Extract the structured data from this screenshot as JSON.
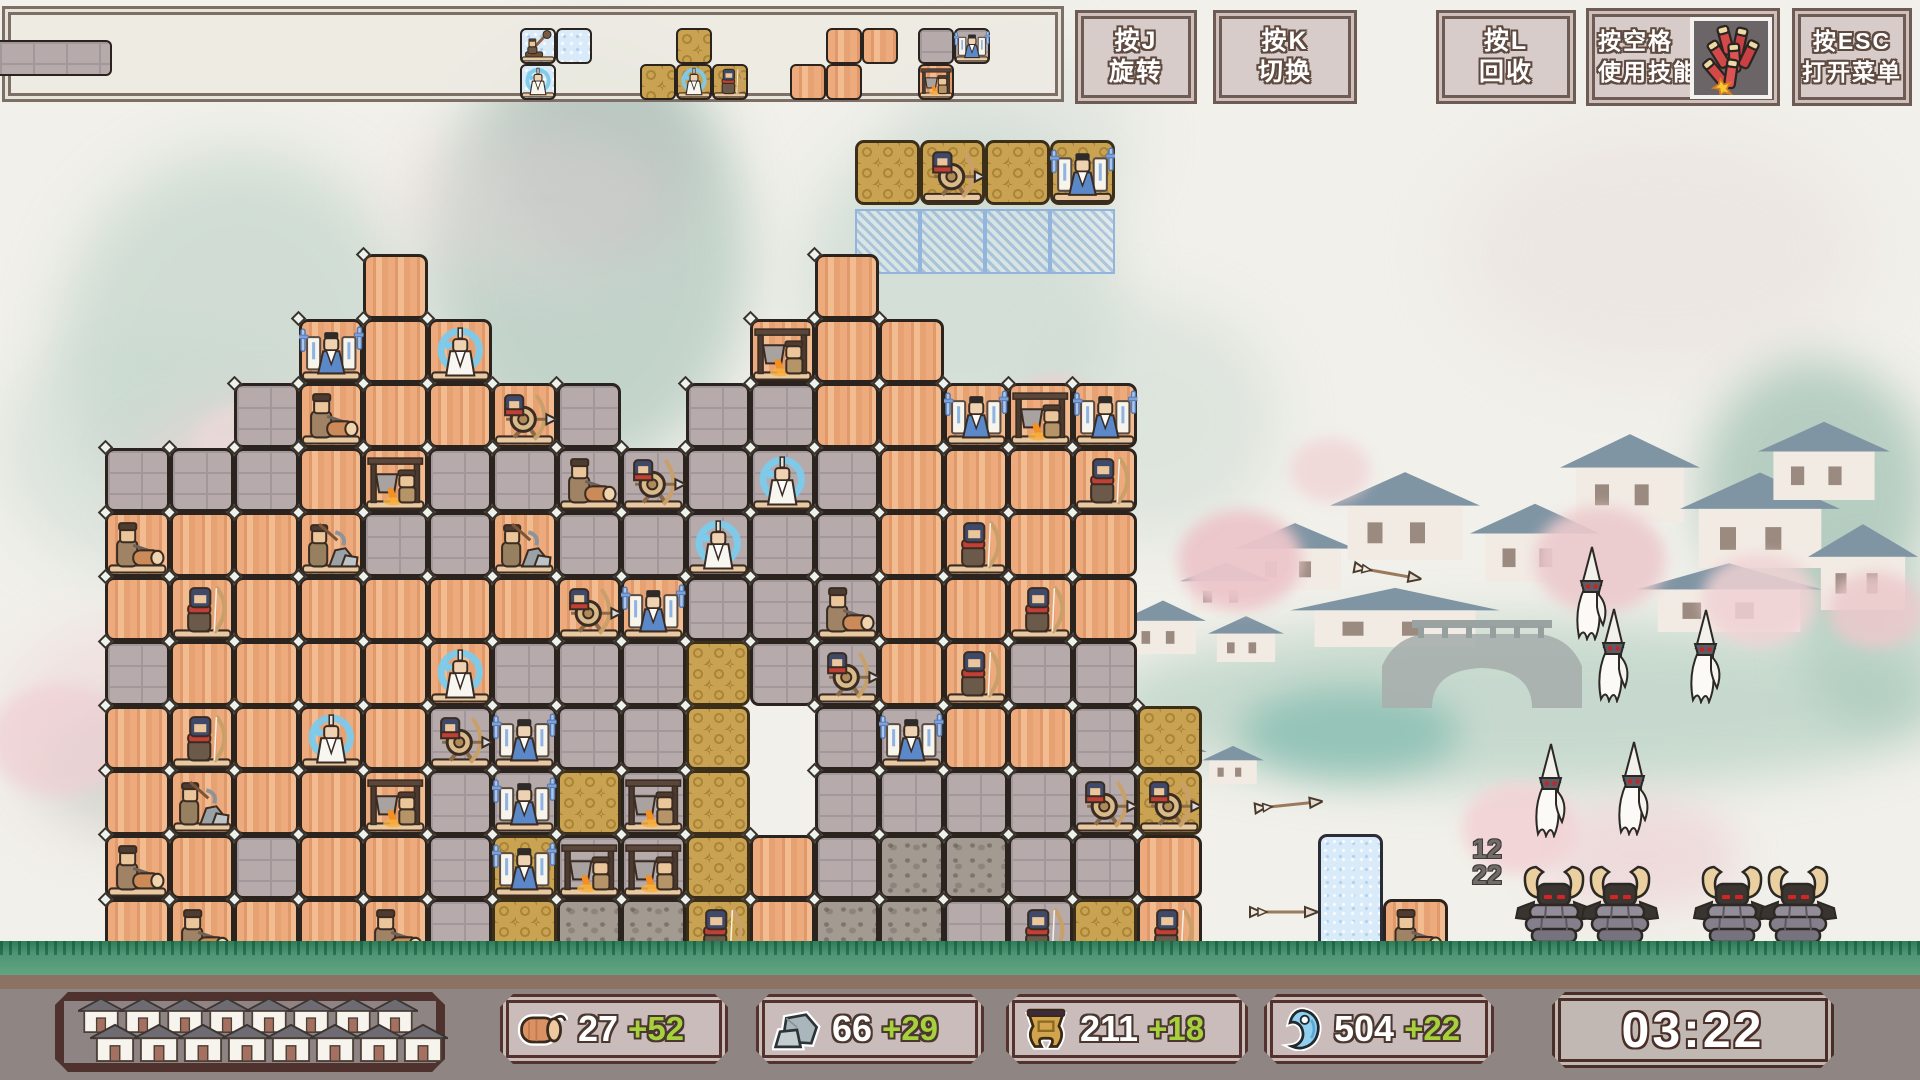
{
  "hud": {
    "buttons": [
      {
        "key": "按J",
        "action": "旋转"
      },
      {
        "key": "按K",
        "action": "切换"
      },
      {
        "key": "按L",
        "action": "回收"
      },
      {
        "key": "按空格",
        "action": "使用技能",
        "icon": "firecracker-icon",
        "icon_ref": "#icon-firecracker"
      },
      {
        "key": "按ESC",
        "action": "打开菜单"
      }
    ],
    "queue": {
      "stub": {
        "type": "S",
        "x": 0,
        "y": 40,
        "w": 112,
        "h": 36
      },
      "pieces": [
        {
          "type": "I",
          "x": 520,
          "cells": [
            [
              0,
              0,
              "catapult",
              ""
            ],
            [
              0,
              1,
              "",
              ""
            ],
            [
              1,
              0,
              "monk",
              ""
            ]
          ]
        },
        {
          "type": "G",
          "x": 640,
          "cells": [
            [
              0,
              1,
              "",
              ""
            ],
            [
              1,
              0,
              "",
              ""
            ],
            [
              1,
              1,
              "monk",
              ""
            ],
            [
              1,
              2,
              "archer",
              ""
            ]
          ]
        },
        {
          "type": "W",
          "x": 790,
          "cells": [
            [
              0,
              1,
              "",
              ""
            ],
            [
              0,
              2,
              "",
              ""
            ],
            [
              1,
              0,
              "",
              ""
            ],
            [
              1,
              1,
              "",
              ""
            ]
          ]
        },
        {
          "type": "S",
          "x": 918,
          "cells": [
            [
              0,
              0,
              "",
              ""
            ],
            [
              0,
              1,
              "general",
              ""
            ],
            [
              1,
              0,
              "forge",
              "W"
            ]
          ]
        }
      ]
    }
  },
  "falling_piece": {
    "type": "G",
    "x": 855,
    "y": 140,
    "cell_size": 65,
    "cells": [
      [
        0,
        0,
        "",
        ""
      ],
      [
        0,
        1,
        "ballista",
        ""
      ],
      [
        0,
        2,
        "",
        ""
      ],
      [
        0,
        3,
        "general",
        ""
      ]
    ],
    "preview": {
      "y": 209,
      "count": 4
    }
  },
  "wall": {
    "origin_x": 105,
    "origin_y": 254,
    "cell_size": 64.5,
    "rows": [
      "....W......W.....",
      "...WWW....WWW....",
      "..SWWWWS.SSWWWWW.",
      "SSSWWSSSSSSSWWWW.",
      "WWWWSSWSSSSSWWWW.",
      "WWWWWWWWWSSSWWWW.",
      "SWWWWWSSSGSSWWSS.",
      "WWWWWSSSSG.SSWWSG",
      "WWWWWSSGSG.SSSSSG",
      "WWSWWSGSSGWSCCSSW",
      "WWWWWSGCCGWCCSSGW"
    ],
    "units": [
      [
        1,
        3,
        "general"
      ],
      [
        1,
        5,
        "monk"
      ],
      [
        1,
        10,
        "forge"
      ],
      [
        2,
        3,
        "woodcutter"
      ],
      [
        2,
        6,
        "ballista"
      ],
      [
        2,
        13,
        "general"
      ],
      [
        2,
        14,
        "forge"
      ],
      [
        2,
        15,
        "general"
      ],
      [
        3,
        4,
        "forge"
      ],
      [
        3,
        7,
        "woodcutter"
      ],
      [
        3,
        8,
        "ballista"
      ],
      [
        3,
        10,
        "monk"
      ],
      [
        3,
        15,
        "archer"
      ],
      [
        4,
        0,
        "woodcutter"
      ],
      [
        4,
        3,
        "miner"
      ],
      [
        4,
        6,
        "miner"
      ],
      [
        4,
        9,
        "monk"
      ],
      [
        4,
        13,
        "archer"
      ],
      [
        5,
        1,
        "archer"
      ],
      [
        5,
        7,
        "ballista"
      ],
      [
        5,
        8,
        "general"
      ],
      [
        5,
        11,
        "woodcutter"
      ],
      [
        5,
        14,
        "archer"
      ],
      [
        6,
        5,
        "monk"
      ],
      [
        6,
        11,
        "ballista"
      ],
      [
        6,
        13,
        "archer"
      ],
      [
        7,
        1,
        "archer"
      ],
      [
        7,
        3,
        "monk"
      ],
      [
        7,
        5,
        "ballista"
      ],
      [
        7,
        6,
        "general"
      ],
      [
        7,
        12,
        "general"
      ],
      [
        8,
        1,
        "miner"
      ],
      [
        8,
        4,
        "forge"
      ],
      [
        8,
        6,
        "general"
      ],
      [
        8,
        8,
        "forge"
      ],
      [
        8,
        15,
        "ballista"
      ],
      [
        8,
        16,
        "ballista"
      ],
      [
        9,
        0,
        "woodcutter"
      ],
      [
        9,
        6,
        "general"
      ],
      [
        9,
        7,
        "forge"
      ],
      [
        9,
        8,
        "forge"
      ],
      [
        10,
        1,
        "woodcutter"
      ],
      [
        10,
        4,
        "woodcutter"
      ],
      [
        10,
        9,
        "archer"
      ],
      [
        10,
        14,
        "archer"
      ],
      [
        10,
        16,
        "archer"
      ]
    ]
  },
  "side_blocks": [
    {
      "type": "I",
      "x": 1318,
      "y": 834,
      "w": 65,
      "h": 129,
      "unit": ""
    },
    {
      "type": "W",
      "x": 1383,
      "y": 899,
      "w": 65,
      "h": 64,
      "unit": "woodcutter"
    }
  ],
  "enemies": {
    "counter_top": "12",
    "counter_bottom": "22",
    "ghosts": [
      [
        1568,
        545
      ],
      [
        1590,
        607
      ],
      [
        1682,
        608
      ],
      [
        1527,
        742
      ],
      [
        1610,
        740
      ]
    ],
    "samurai": [
      [
        1512,
        862
      ],
      [
        1578,
        862
      ],
      [
        1690,
        862
      ],
      [
        1756,
        862
      ]
    ]
  },
  "arrows": [
    [
      1253,
      798,
      -6
    ],
    [
      1248,
      905,
      0
    ],
    [
      1352,
      566,
      10
    ]
  ],
  "resources": [
    {
      "name": "wood",
      "icon": "log-icon",
      "icon_ref": "#icon-log",
      "value": "27",
      "delta": "+52"
    },
    {
      "name": "stone",
      "icon": "stone-icon",
      "icon_ref": "#icon-stone",
      "value": "66",
      "delta": "+29"
    },
    {
      "name": "bronze",
      "icon": "ding-icon",
      "icon_ref": "#icon-ding",
      "value": "211",
      "delta": "+18"
    },
    {
      "name": "jade",
      "icon": "jade-icon",
      "icon_ref": "#icon-jade",
      "value": "504",
      "delta": "+22"
    }
  ],
  "timer": "03:22",
  "village_panel": {
    "back_houses": 8,
    "front_houses": 8
  },
  "colors": {
    "wood": "#e8a878",
    "stone": "#b6abaa",
    "gold": "#c9a352",
    "ice": "#d9ebf9",
    "delta_green": "#a6d13c",
    "frame_dark": "#54322e",
    "bar_bg": "#8f8583",
    "hud_fill": "#d6c8c6"
  }
}
